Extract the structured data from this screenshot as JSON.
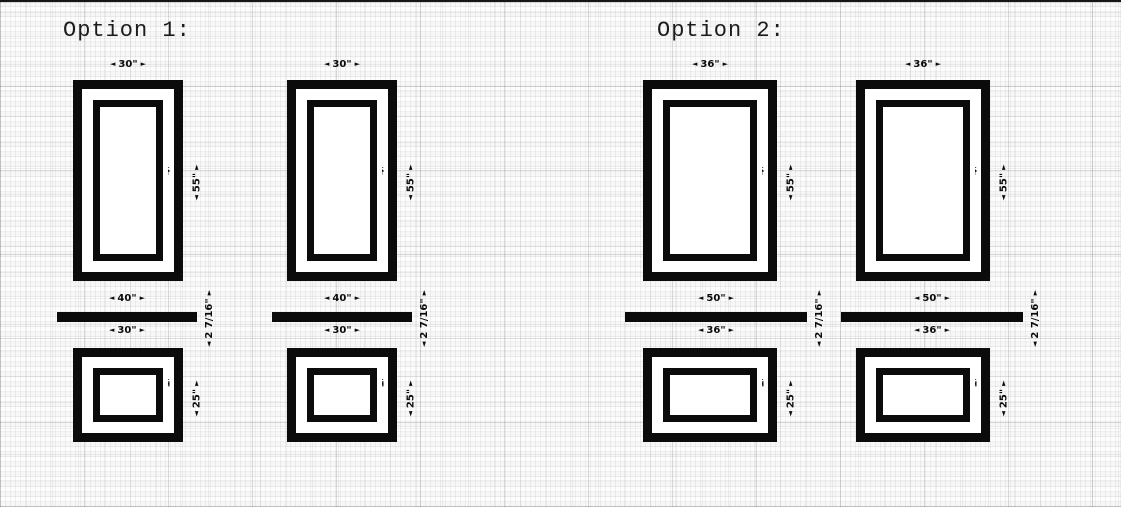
{
  "canvas": {
    "paper_color": "#fdfdfd",
    "ink_color": "#0b0b0b"
  },
  "glyphs": {
    "arrow_left": "◄",
    "arrow_right": "►",
    "arrow_up": "▲",
    "arrow_down": "▼"
  },
  "options": [
    {
      "title": "Option 1:",
      "tall_frame": {
        "width": "30\"",
        "height": "55\"",
        "inner_width": "20\"",
        "inner_height": "45\""
      },
      "shelf": {
        "length": "40\"",
        "inner_length": "30\"",
        "thickness": "2 7/16\""
      },
      "short_frame": {
        "height": "25\"",
        "inner_width": "20\"",
        "inner_height": "15\""
      }
    },
    {
      "title": "Option 2:",
      "tall_frame": {
        "width": "36\"",
        "height": "55\"",
        "inner_width": "26\"",
        "inner_height": "45\""
      },
      "shelf": {
        "length": "50\"",
        "inner_length": "36\"",
        "thickness": "2 7/16\""
      },
      "short_frame": {
        "height": "25\"",
        "inner_width": "26\"",
        "inner_height": "15\""
      }
    }
  ]
}
